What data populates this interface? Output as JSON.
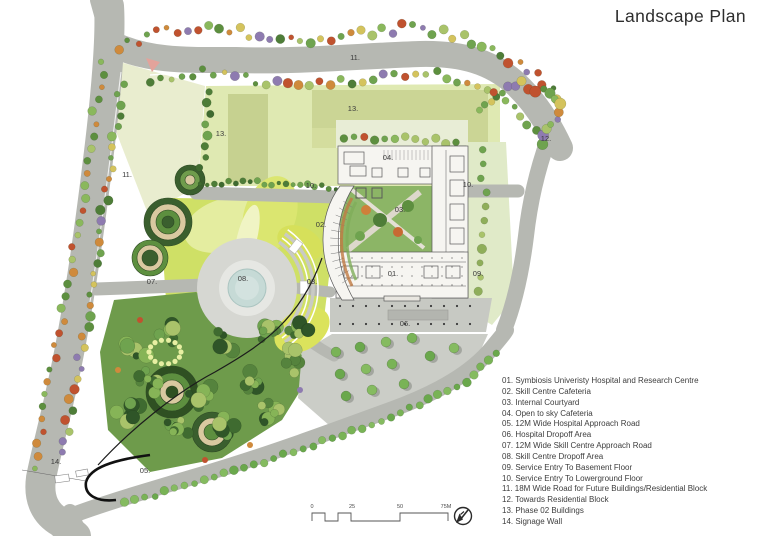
{
  "title": "Landscape Plan",
  "palette": {
    "road": "#b6b8b2",
    "plaza": "#c9cbc5",
    "field": "#dfe9b2",
    "field_block": "#c6d190",
    "lawn": "#cfe066",
    "forest": "#6e9b4b",
    "pond": "#c6dad6",
    "tree_green": "#6fa34f",
    "label_text": "#3a3a3a",
    "wall_black": "#111111"
  },
  "legend": {
    "items": [
      "01. Symbiosis Univeristy Hospital and Research Centre",
      "02. Skill Centre Cafeteria",
      "03. Internal Courtyard",
      "04. Open to sky Cafeteria",
      "05. 12M Wide Hospital Approach Road",
      "06. Hospital Dropoff Area",
      "07. 12M Wide Skill Centre Approach Road",
      "08. Skill Centre Dropoff Area",
      "09. Service Entry To Basement Floor",
      "10. Service Entry To Lowerground Floor",
      "11. 18M Wide Road for Future Buildings/Residential Block",
      "12. Towards Residential Block",
      "13. Phase 02 Buildings",
      "14. Signage Wall"
    ]
  },
  "plan_labels": [
    {
      "text": "11.",
      "x": 355,
      "y": 60
    },
    {
      "text": "13.",
      "x": 221,
      "y": 136
    },
    {
      "text": "13.",
      "x": 353,
      "y": 111
    },
    {
      "text": "11.",
      "x": 127,
      "y": 177
    },
    {
      "text": "10.",
      "x": 311,
      "y": 188
    },
    {
      "text": "10.",
      "x": 468,
      "y": 187
    },
    {
      "text": "12.",
      "x": 546,
      "y": 141
    },
    {
      "text": "04.",
      "x": 388,
      "y": 160
    },
    {
      "text": "03.",
      "x": 400,
      "y": 212
    },
    {
      "text": "02.",
      "x": 321,
      "y": 227
    },
    {
      "text": "01.",
      "x": 393,
      "y": 276
    },
    {
      "text": "09.",
      "x": 478,
      "y": 276
    },
    {
      "text": "08.",
      "x": 243,
      "y": 281
    },
    {
      "text": "08.",
      "x": 312,
      "y": 284
    },
    {
      "text": "07.",
      "x": 152,
      "y": 284
    },
    {
      "text": "06.",
      "x": 405,
      "y": 326
    },
    {
      "text": "05.",
      "x": 145,
      "y": 473
    },
    {
      "text": "14.",
      "x": 56,
      "y": 464
    }
  ],
  "scale_bar": {
    "labels": [
      {
        "text": "0",
        "x": 312
      },
      {
        "text": "25",
        "x": 352
      },
      {
        "text": "50",
        "x": 400
      },
      {
        "text": "75M",
        "x": 446
      }
    ]
  }
}
